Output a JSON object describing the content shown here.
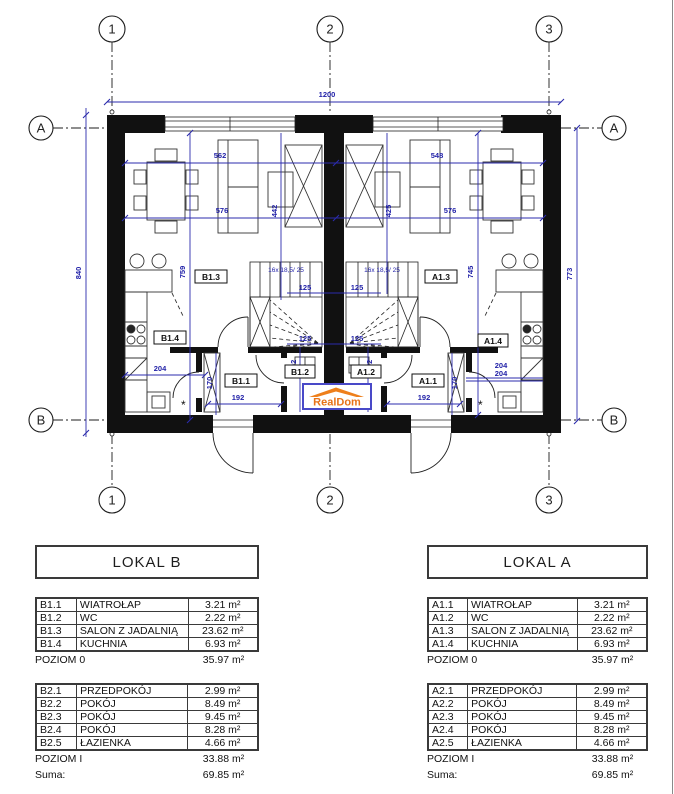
{
  "plan": {
    "grid": {
      "c1": "1",
      "c2": "2",
      "c3": "3",
      "rA": "A",
      "rB": "B"
    },
    "dims": {
      "total_w": "1200",
      "h_left": "840",
      "h_right": "773",
      "b_w1": "562",
      "b_w2": "576",
      "a_w1": "548",
      "a_w2": "576",
      "b_void": "442",
      "a_void": "425",
      "b_depth": "759",
      "a_depth": "745",
      "stair": "125",
      "wc": "302",
      "kitchen": "204",
      "hall": "192",
      "ward": "170"
    },
    "stair_note": "16x 18,5/ 25",
    "star": "*",
    "rooms": {
      "b13": "B1.3",
      "b14": "B1.4",
      "b11": "B1.1",
      "b12": "B1.2",
      "a13": "A1.3",
      "a14": "A1.4",
      "a11": "A1.1",
      "a12": "A1.2"
    },
    "logo": "RealDom"
  },
  "tables": {
    "lokal_b": {
      "title": "LOKAL B",
      "level0": {
        "rows": [
          {
            "code": "B1.1",
            "name": "WIATROŁAP",
            "area": "3.21 m²"
          },
          {
            "code": "B1.2",
            "name": "WC",
            "area": "2.22 m²"
          },
          {
            "code": "B1.3",
            "name": "SALON Z JADALNIĄ",
            "area": "23.62 m²"
          },
          {
            "code": "B1.4",
            "name": "KUCHNIA",
            "area": "6.93 m²"
          }
        ],
        "total_label": "POZIOM 0",
        "total_area": "35.97 m²"
      },
      "level1": {
        "rows": [
          {
            "code": "B2.1",
            "name": "PRZEDPOKÓJ",
            "area": "2.99 m²"
          },
          {
            "code": "B2.2",
            "name": "POKÓJ",
            "area": "8.49 m²"
          },
          {
            "code": "B2.3",
            "name": "POKÓJ",
            "area": "9.45 m²"
          },
          {
            "code": "B2.4",
            "name": "POKÓJ",
            "area": "8.28 m²"
          },
          {
            "code": "B2.5",
            "name": "ŁAZIENKA",
            "area": "4.66 m²"
          }
        ],
        "total_label": "POZIOM I",
        "total_area": "33.88 m²"
      },
      "sum_label": "Suma:",
      "sum_area": "69.85 m²"
    },
    "lokal_a": {
      "title": "LOKAL A",
      "level0": {
        "rows": [
          {
            "code": "A1.1",
            "name": "WIATROŁAP",
            "area": "3.21 m²"
          },
          {
            "code": "A1.2",
            "name": "WC",
            "area": "2.22 m²"
          },
          {
            "code": "A1.3",
            "name": "SALON Z JADALNIĄ",
            "area": "23.62 m²"
          },
          {
            "code": "A1.4",
            "name": "KUCHNIA",
            "area": "6.93 m²"
          }
        ],
        "total_label": "POZIOM 0",
        "total_area": "35.97 m²"
      },
      "level1": {
        "rows": [
          {
            "code": "A2.1",
            "name": "PRZEDPOKÓJ",
            "area": "2.99 m²"
          },
          {
            "code": "A2.2",
            "name": "POKÓJ",
            "area": "8.49 m²"
          },
          {
            "code": "A2.3",
            "name": "POKÓJ",
            "area": "9.45 m²"
          },
          {
            "code": "A2.4",
            "name": "POKÓJ",
            "area": "8.28 m²"
          },
          {
            "code": "A2.5",
            "name": "ŁAZIENKA",
            "area": "4.66 m²"
          }
        ],
        "total_label": "POZIOM I",
        "total_area": "33.88 m²"
      },
      "sum_label": "Suma:",
      "sum_area": "69.85 m²"
    }
  },
  "colors": {
    "dimension_blue": "#2b2bac",
    "logo_orange": "#ee7f1b",
    "logo_border_blue": "#4949c8",
    "wall_black": "#111111"
  }
}
